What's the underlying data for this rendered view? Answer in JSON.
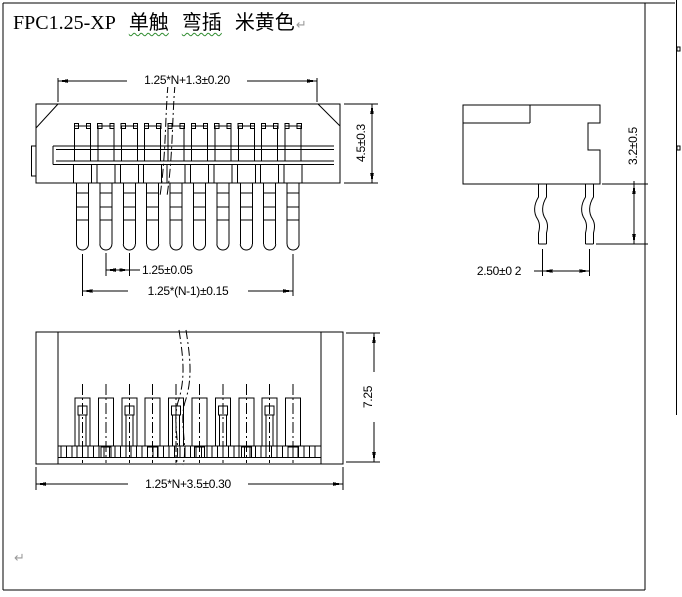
{
  "title": {
    "part_number": "FPC1.25-XP",
    "feature_1": "单触",
    "feature_2": "弯插",
    "color_name": "米黄色",
    "paragraph_mark": "↵"
  },
  "dimensions": {
    "front_total_width": "1.25*N+1.3±0.20",
    "front_height": "4.5±0.3",
    "pin_pitch": "1.25±0.05",
    "pin_span": "1.25*(N-1)±0.15",
    "side_tail_length": "3.2±0.5",
    "side_tail_span": "2.50±0 2",
    "bottom_depth": "7.25",
    "bottom_total_width": "1.25*N+3.5±0.30"
  },
  "footer": {
    "paragraph_mark": "↵"
  },
  "drawing": {
    "pins_shown": 10,
    "line_color": "#000000",
    "spellcheck_underline_color": "#2e8b2e",
    "paragraph_mark_color": "#9a9a9a"
  }
}
